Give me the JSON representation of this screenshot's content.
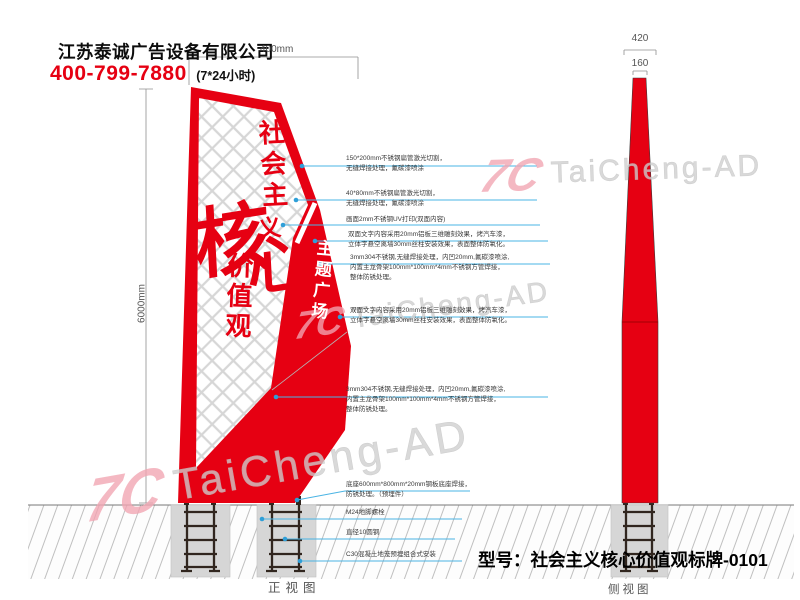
{
  "header": {
    "company": "江苏泰诚广告设备有限公司",
    "phone": "400-799-7880",
    "hours": "(7*24小时)"
  },
  "dimensions": {
    "top_width": "400mm",
    "total_height": "6000mm",
    "side_base_width": "420",
    "side_top_width": "160"
  },
  "sign": {
    "slogan_top": "社会主",
    "slogan_yi": "义",
    "core_char1": "核",
    "core_char2": "心",
    "slogan_bottom": "价值观",
    "wedge_text": "主题广场"
  },
  "annotations": {
    "a1": "150*200mm不锈钢扁管激光切割，\n无缝焊接处理，氟碳漆喷涂",
    "a2": "40*80mm不锈钢扁管激光切割，\n无缝焊接处理，氟碳漆喷涂",
    "a3": "画面2mm不锈钢UV打印(双面内容)",
    "a4": "双面文字内容采用20mm铝板三维雕刻效果，烤汽车漆，\n立体字悬空离墙30mm丝柱安装效果，表面整体防氧化。",
    "a5": "3mm304不锈钢,无缝焊接处理，内凹20mm,氟碳漆喷涂,\n内置主龙骨架100mm*100mm*4mm不锈钢方管焊接，\n整体防锈处理。",
    "a8": "底座600mm*800mm*20mm钢板底座焊接，\n防锈处理。（预埋件）",
    "a9": "M24地脚螺栓",
    "a10": "直径10圆钢",
    "a11": "C30混凝土地笼预埋组合式安装"
  },
  "watermark": {
    "logo": "7C",
    "brand": "TaiCheng-AD"
  },
  "footer": {
    "model": "型号：社会主义核心价值观标牌-0101",
    "front_view_label": "正视图",
    "side_view_label": "侧视图"
  },
  "colors": {
    "red": "#e60012",
    "leader_blue": "#4ab4e4",
    "watermark_pink": "#f2a5b2",
    "lattice_gray": "#d6d6d6"
  }
}
